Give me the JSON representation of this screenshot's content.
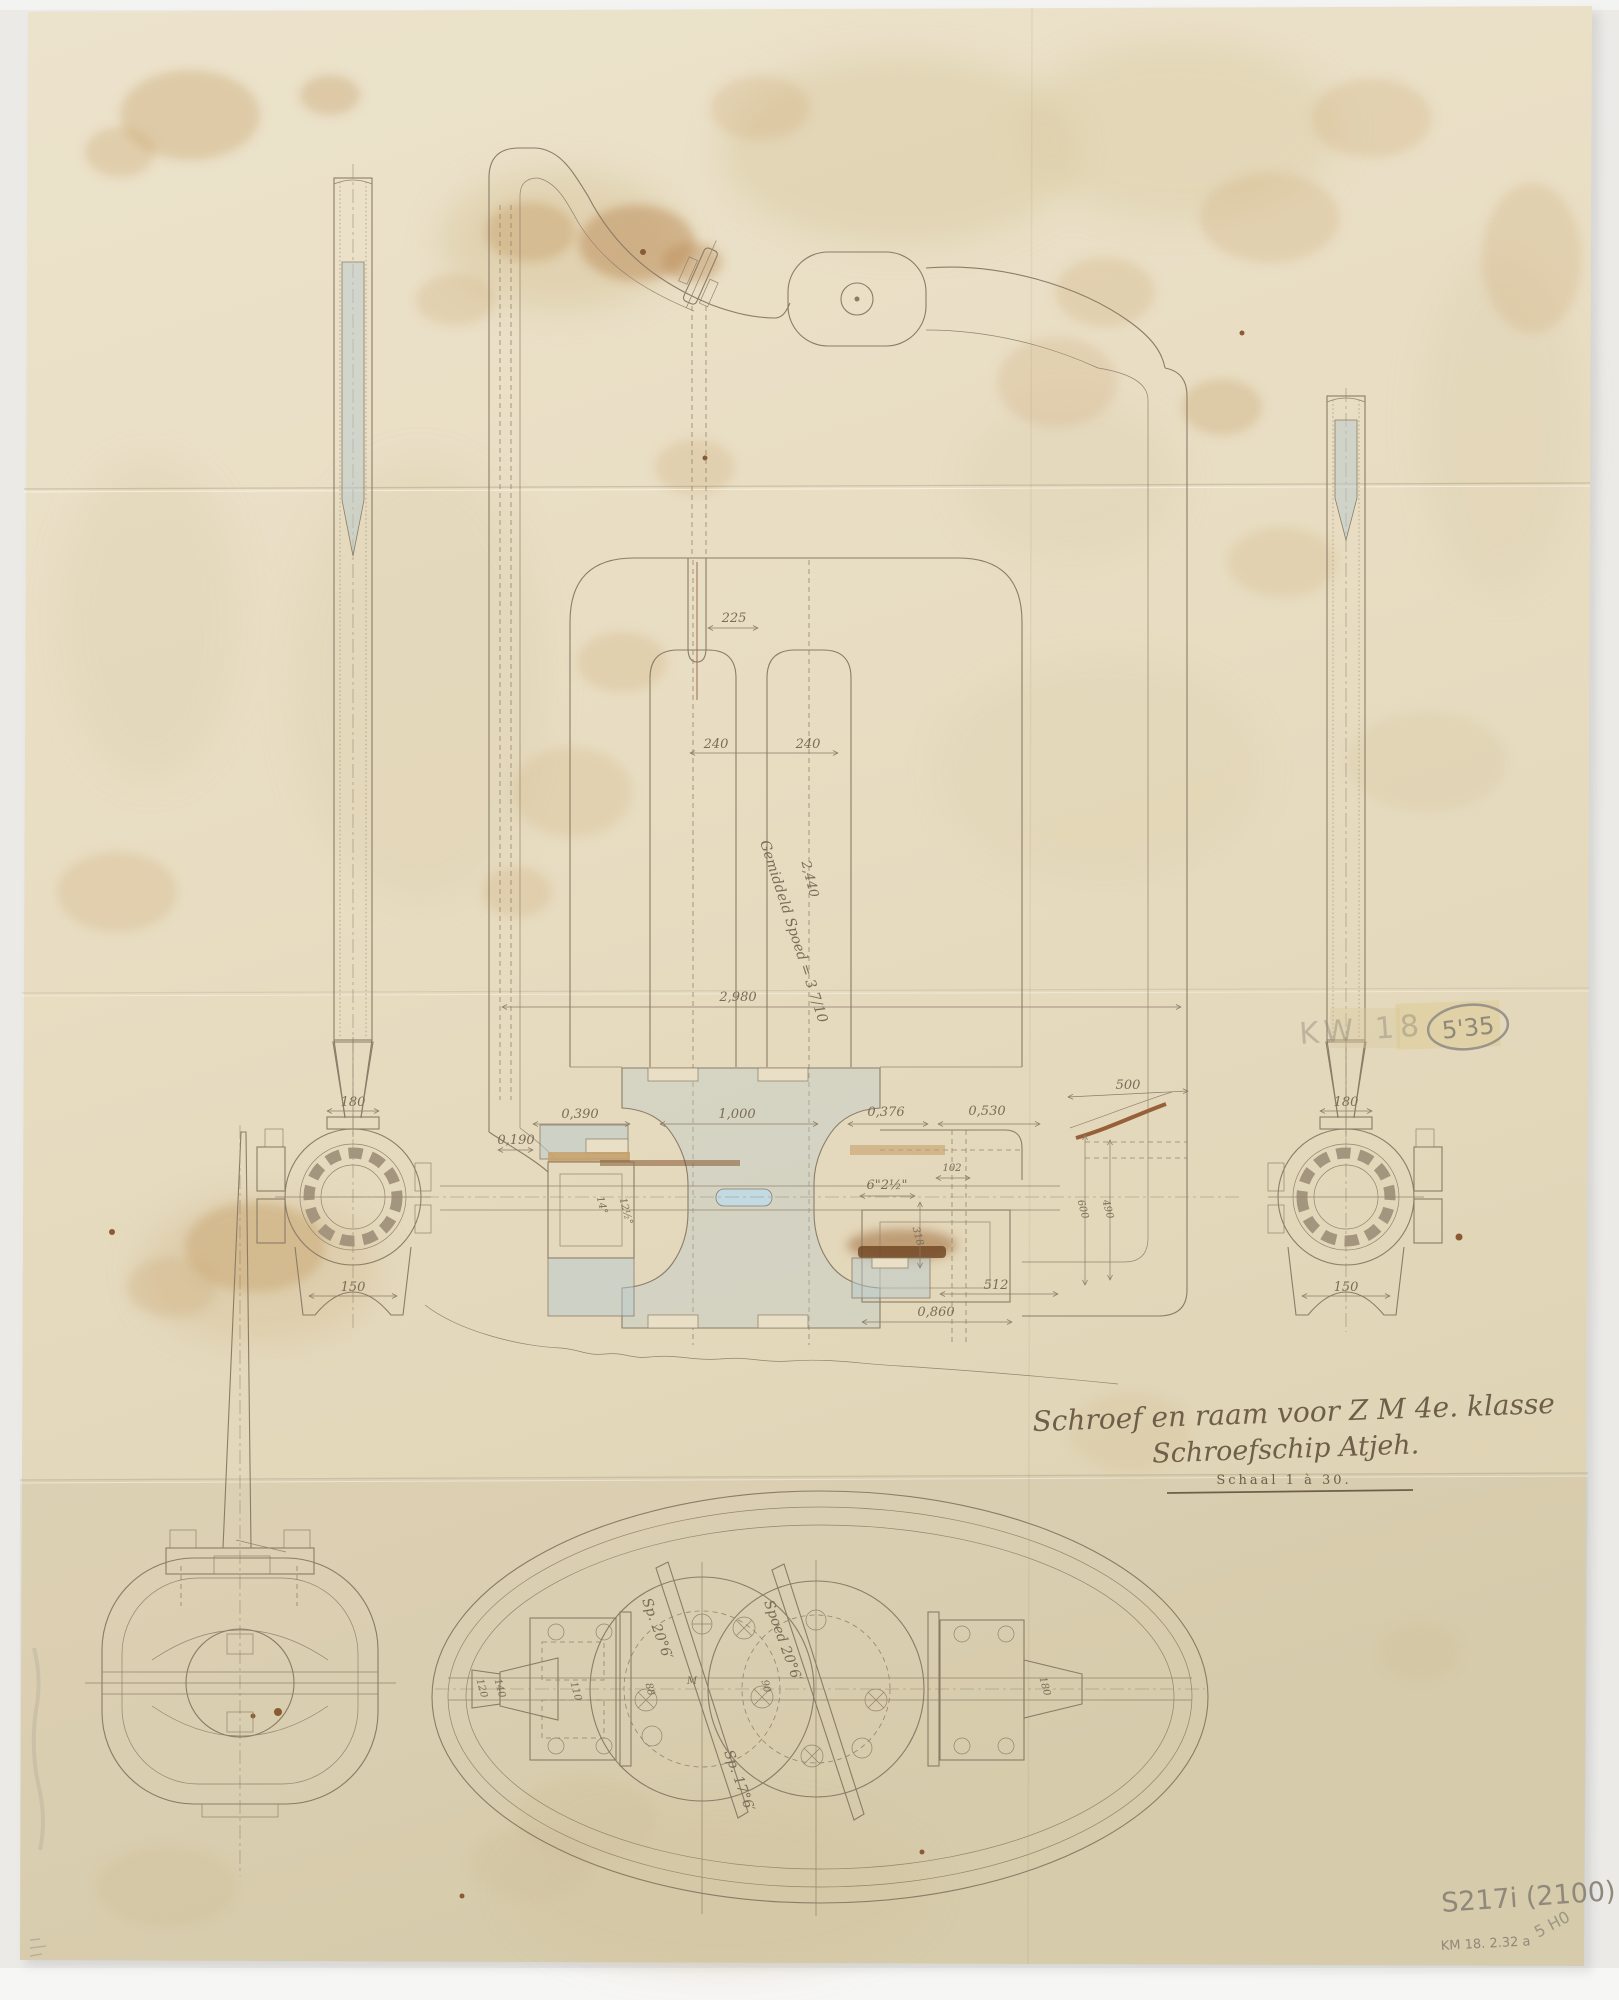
{
  "title_block": {
    "line1": "Schroef en raam voor Z M 4e. klasse",
    "line2": "Schroefschip Atjeh.",
    "scale": "Schaal 1 à 30."
  },
  "pencil_notes": {
    "circled": "5'35",
    "faded_left": "KW 18",
    "catalog": "S217i (2100)",
    "date_code": "KM 18. 2.32 a",
    "diagonal": "5 H0"
  },
  "elevation_dims": {
    "slot": "225",
    "blade_pitch_left": "240",
    "blade_pitch_right": "240",
    "height": "2,440",
    "pitch_note": "Gemiddeld Spoed = 3 7/10",
    "width": "2,980",
    "hub_left_outer": "0,190",
    "hub_left": "0,390",
    "hub_center": "1,000",
    "hub_right": "0,376",
    "aft_a": "0,530",
    "aft_b": "500",
    "detail_small": "102",
    "shaft_note": "6\"2½\"",
    "vert_a": "318",
    "vert_b": "600",
    "vert_c": "490",
    "base_a": "512",
    "base_b": "0,860",
    "angle_a": "14°",
    "angle_b": "12½°"
  },
  "left_section": {
    "top": "180",
    "bottom": "150"
  },
  "right_section": {
    "top": "180",
    "bottom": "150"
  },
  "plan_view": {
    "pitch_label_a": "Sp. 20°6′",
    "pitch_label_b": "Spoed 20°6′",
    "pitch_label_c": "Sp. 17°6′",
    "dim_a": "120",
    "dim_b": "140",
    "dim_c": "110",
    "dim_d": "88",
    "mark": "M",
    "dim_e": "90",
    "dim_f": "180"
  }
}
